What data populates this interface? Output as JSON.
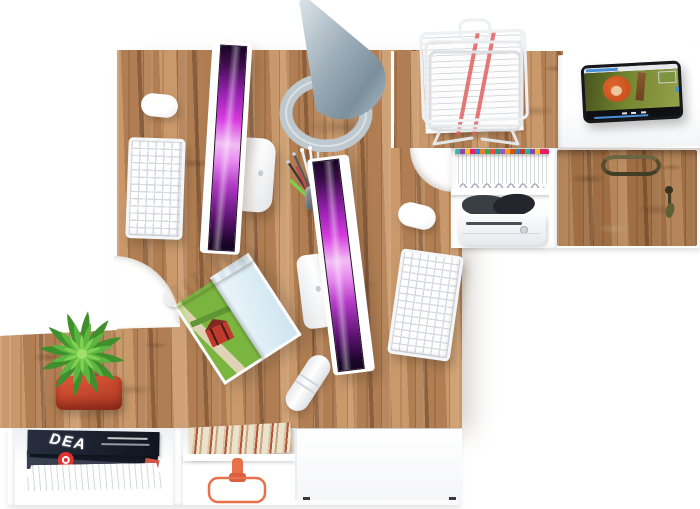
{
  "scene": {
    "description": "Top view 3D render of a two-person corner office workstation: oak desks with two all-in-one computers, white keyboards and mice, cone desk lamp, wire paper tray, tablet playing a movie, pen cup, open magazine, succulent in red pot, and white storage shelving with magazines, books, orange headphones, files and a locked wood drawer.",
    "background_color": "#ffffff"
  },
  "palette": {
    "wood_mid": "#b07e52",
    "wood_light": "#c9996b",
    "wood_dark": "#8a5f3d",
    "screen_dark": "#160524",
    "screen_mid": "#8f1fa8",
    "screen_purple": "#d63ae0",
    "screen_light": "#f1bdf4",
    "lamp_light": "#dde4e9",
    "lamp_mid": "#9cadb8",
    "lamp_dark": "#7b8f9c",
    "lamp_base": "#bdc8cf",
    "plant_dark": "#3f8f2d",
    "plant_mid": "#5cb53e",
    "plant_light": "#7fd153",
    "pot_red": "#e2573a",
    "pot_red_dark": "#a83722",
    "hp_orange": "#e8714c",
    "stripe_red": "#e06060",
    "mag_navy": "#272e3e",
    "badge_red": "#e03131",
    "book_cream": "#ece2cc",
    "book_red": "#b5523c",
    "book_tan": "#c3a87f",
    "handle_bronze": "#6f6845",
    "key_gap": "#d5d9e0",
    "tab_frame": "#17181c",
    "tab_green": "#76862f",
    "tab_hair": "#c1491b",
    "tab_skin": "#eec79f",
    "tab_blue": "#4a90d9",
    "field_green": "#7ab540",
    "house_red": "#c0392d",
    "sky_blue": "#cfe4f0",
    "path_beige": "#ded3b4"
  },
  "file_tab_colors": [
    "#3bb7a8",
    "#8e44ad",
    "#f1c40f",
    "#e91e63",
    "#2980d9",
    "#e67e22",
    "#27ae60",
    "#e74c3c",
    "#16a085",
    "#9b59b6",
    "#f39c12",
    "#d35400",
    "#2c82c9",
    "#c0392b",
    "#1abc9c"
  ],
  "bottom_shelf": {
    "magazine_title": "DEA"
  },
  "objects": [
    {
      "name": "desk-lamp",
      "desc": "gray metal cone lamp with oval ring base"
    },
    {
      "name": "wire-paper-basket",
      "desc": "white wire letter tray holding printed sheets with red stripes"
    },
    {
      "name": "tablet-video-player",
      "desc": "black tablet playing an animated movie with red-haired character"
    },
    {
      "name": "imac-workstation-1",
      "desc": "white all-in-one computer, purple screen, keyboard, mouse"
    },
    {
      "name": "imac-workstation-2",
      "desc": "white all-in-one computer, purple screen, keyboard, mouse"
    },
    {
      "name": "pen-cup",
      "desc": "metal cup with pens, pencils and green highlighter"
    },
    {
      "name": "open-magazine",
      "desc": "rolled-open magazine showing red house in green field"
    },
    {
      "name": "succulent-plant",
      "desc": "spiky green succulent in square red pot"
    },
    {
      "name": "magazine-pile",
      "desc": "dark magazines stacked in white shelf"
    },
    {
      "name": "books-row",
      "desc": "books seen from top in shelf"
    },
    {
      "name": "headphones",
      "desc": "orange headphones in shelf cubby"
    },
    {
      "name": "hanging-files",
      "desc": "white files with multicolor index tabs"
    },
    {
      "name": "printer-drawer",
      "desc": "white device below files"
    },
    {
      "name": "wood-drawer",
      "desc": "oak drawer front with bronze handle and key with tassel"
    },
    {
      "name": "usb-cable-roll",
      "desc": "white rolled cable on desk"
    }
  ]
}
